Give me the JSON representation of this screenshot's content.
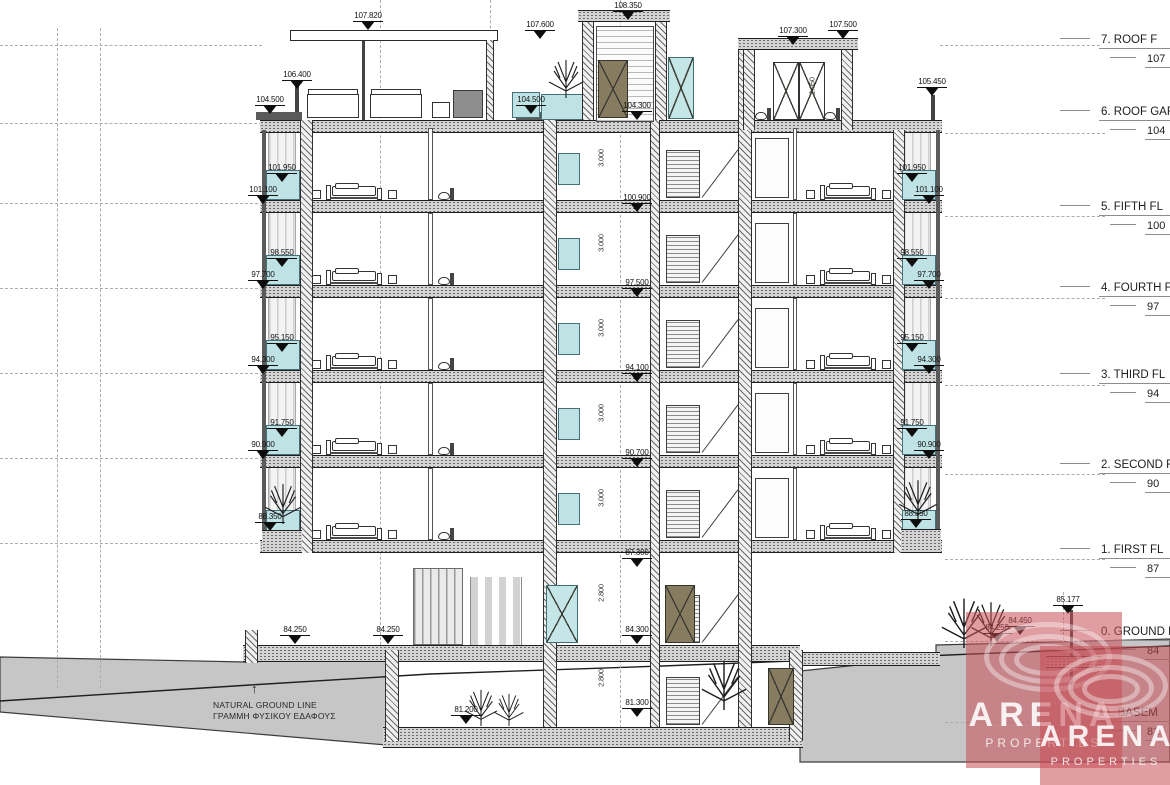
{
  "drawing": {
    "floor_labels": [
      {
        "label": "7. ROOF F",
        "elevation": "107",
        "y": 34
      },
      {
        "label": "6. ROOF GAR",
        "elevation": "104",
        "y": 106
      },
      {
        "label": "5. FIFTH FL",
        "elevation": "100",
        "y": 201
      },
      {
        "label": "4. FOURTH FL",
        "elevation": "97",
        "y": 282
      },
      {
        "label": "3. THIRD FL",
        "elevation": "94",
        "y": 369
      },
      {
        "label": "2. SECOND FL",
        "elevation": "90",
        "y": 459
      },
      {
        "label": "1. FIRST FL",
        "elevation": "87",
        "y": 544
      },
      {
        "label": "0. GROUND FL",
        "elevation": "84",
        "y": 626
      },
      {
        "label": "-1. BASEM",
        "elevation": "81",
        "y": 707
      }
    ],
    "elevation_markers": [
      {
        "value": "107.820",
        "x": 368,
        "y": 12
      },
      {
        "value": "108.350",
        "x": 628,
        "y": 2
      },
      {
        "value": "107.600",
        "x": 540,
        "y": 21
      },
      {
        "value": "107.300",
        "x": 793,
        "y": 27
      },
      {
        "value": "107.500",
        "x": 843,
        "y": 21
      },
      {
        "value": "106.400",
        "x": 297,
        "y": 71
      },
      {
        "value": "105.450",
        "x": 932,
        "y": 78
      },
      {
        "value": "104.500",
        "x": 270,
        "y": 96
      },
      {
        "value": "104.500",
        "x": 531,
        "y": 96
      },
      {
        "value": "104.300",
        "x": 637,
        "y": 102
      },
      {
        "value": "100.900",
        "x": 637,
        "y": 194
      },
      {
        "value": "97.500",
        "x": 637,
        "y": 279
      },
      {
        "value": "94.100",
        "x": 637,
        "y": 364
      },
      {
        "value": "90.700",
        "x": 637,
        "y": 449
      },
      {
        "value": "87.300",
        "x": 637,
        "y": 549
      },
      {
        "value": "84.300",
        "x": 637,
        "y": 626
      },
      {
        "value": "81.300",
        "x": 637,
        "y": 699
      },
      {
        "value": "101.950",
        "x": 282,
        "y": 164
      },
      {
        "value": "101.100",
        "x": 263,
        "y": 186
      },
      {
        "value": "98.550",
        "x": 282,
        "y": 249
      },
      {
        "value": "97.700",
        "x": 263,
        "y": 271
      },
      {
        "value": "95.150",
        "x": 282,
        "y": 334
      },
      {
        "value": "94.300",
        "x": 263,
        "y": 356
      },
      {
        "value": "91.750",
        "x": 282,
        "y": 419
      },
      {
        "value": "90.900",
        "x": 263,
        "y": 441
      },
      {
        "value": "88.350",
        "x": 270,
        "y": 513
      },
      {
        "value": "101.950",
        "x": 912,
        "y": 164
      },
      {
        "value": "101.100",
        "x": 929,
        "y": 186
      },
      {
        "value": "98.550",
        "x": 912,
        "y": 249
      },
      {
        "value": "97.700",
        "x": 929,
        "y": 271
      },
      {
        "value": "95.150",
        "x": 912,
        "y": 334
      },
      {
        "value": "94.300",
        "x": 929,
        "y": 356
      },
      {
        "value": "91.750",
        "x": 912,
        "y": 419
      },
      {
        "value": "90.900",
        "x": 929,
        "y": 441
      },
      {
        "value": "88.350",
        "x": 916,
        "y": 510
      },
      {
        "value": "84.250",
        "x": 295,
        "y": 626
      },
      {
        "value": "84.250",
        "x": 388,
        "y": 626
      },
      {
        "value": "81.200",
        "x": 466,
        "y": 706
      },
      {
        "value": "84.250",
        "x": 997,
        "y": 624
      },
      {
        "value": "84.450",
        "x": 1020,
        "y": 617
      },
      {
        "value": "85.177",
        "x": 1068,
        "y": 596
      }
    ],
    "dimensions": [
      {
        "text": "3.000",
        "x": 601,
        "y": 158
      },
      {
        "text": "3.000",
        "x": 601,
        "y": 243
      },
      {
        "text": "3.000",
        "x": 601,
        "y": 328
      },
      {
        "text": "3.000",
        "x": 601,
        "y": 413
      },
      {
        "text": "3.000",
        "x": 601,
        "y": 498
      },
      {
        "text": "2.800",
        "x": 601,
        "y": 593
      },
      {
        "text": "2.800",
        "x": 601,
        "y": 678
      },
      {
        "text": "2.950",
        "x": 812,
        "y": 86
      }
    ],
    "annotations": {
      "natural_ground_line_en": "NATURAL GROUND LINE",
      "natural_ground_line_gr": "ΓΡΑΜΜΗ ΦΥΣΙΚΟΥ ΕΔΑΦΟΥΣ"
    },
    "colors": {
      "glass_teal": "#bfe3e4",
      "door_brown": "#877b60",
      "earth_gray": "#c6c6c6",
      "watermark_red": "#c44e56"
    }
  },
  "watermark": {
    "name": "ARENA",
    "subtitle": "PROPERTIES"
  }
}
